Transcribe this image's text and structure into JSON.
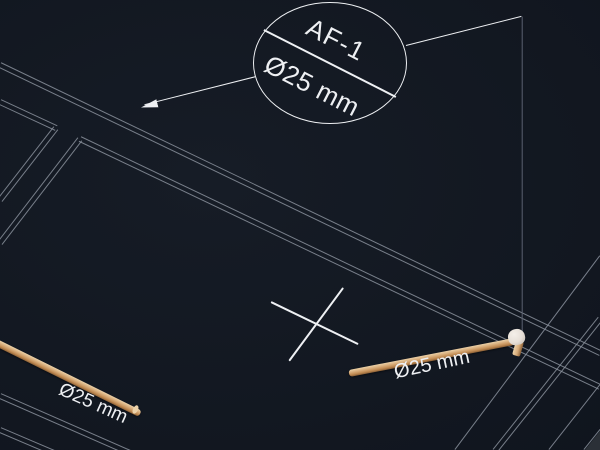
{
  "canvas": {
    "colors": {
      "bg": "#161c26",
      "wall": "#8a919c",
      "dim": "#5a6170",
      "ink": "#eef0f3",
      "pipe_hi": "#ecd2a9",
      "pipe_mid": "#d7ab79",
      "pipe_lo": "#8a5f35",
      "fitting": "#e6dfd7",
      "corner": "#2b3037"
    }
  },
  "callout": {
    "label": "AF-1",
    "size": "Ø25 mm"
  },
  "pipe_labels": {
    "left": "Ø25 mm",
    "right": "Ø25 mm"
  }
}
